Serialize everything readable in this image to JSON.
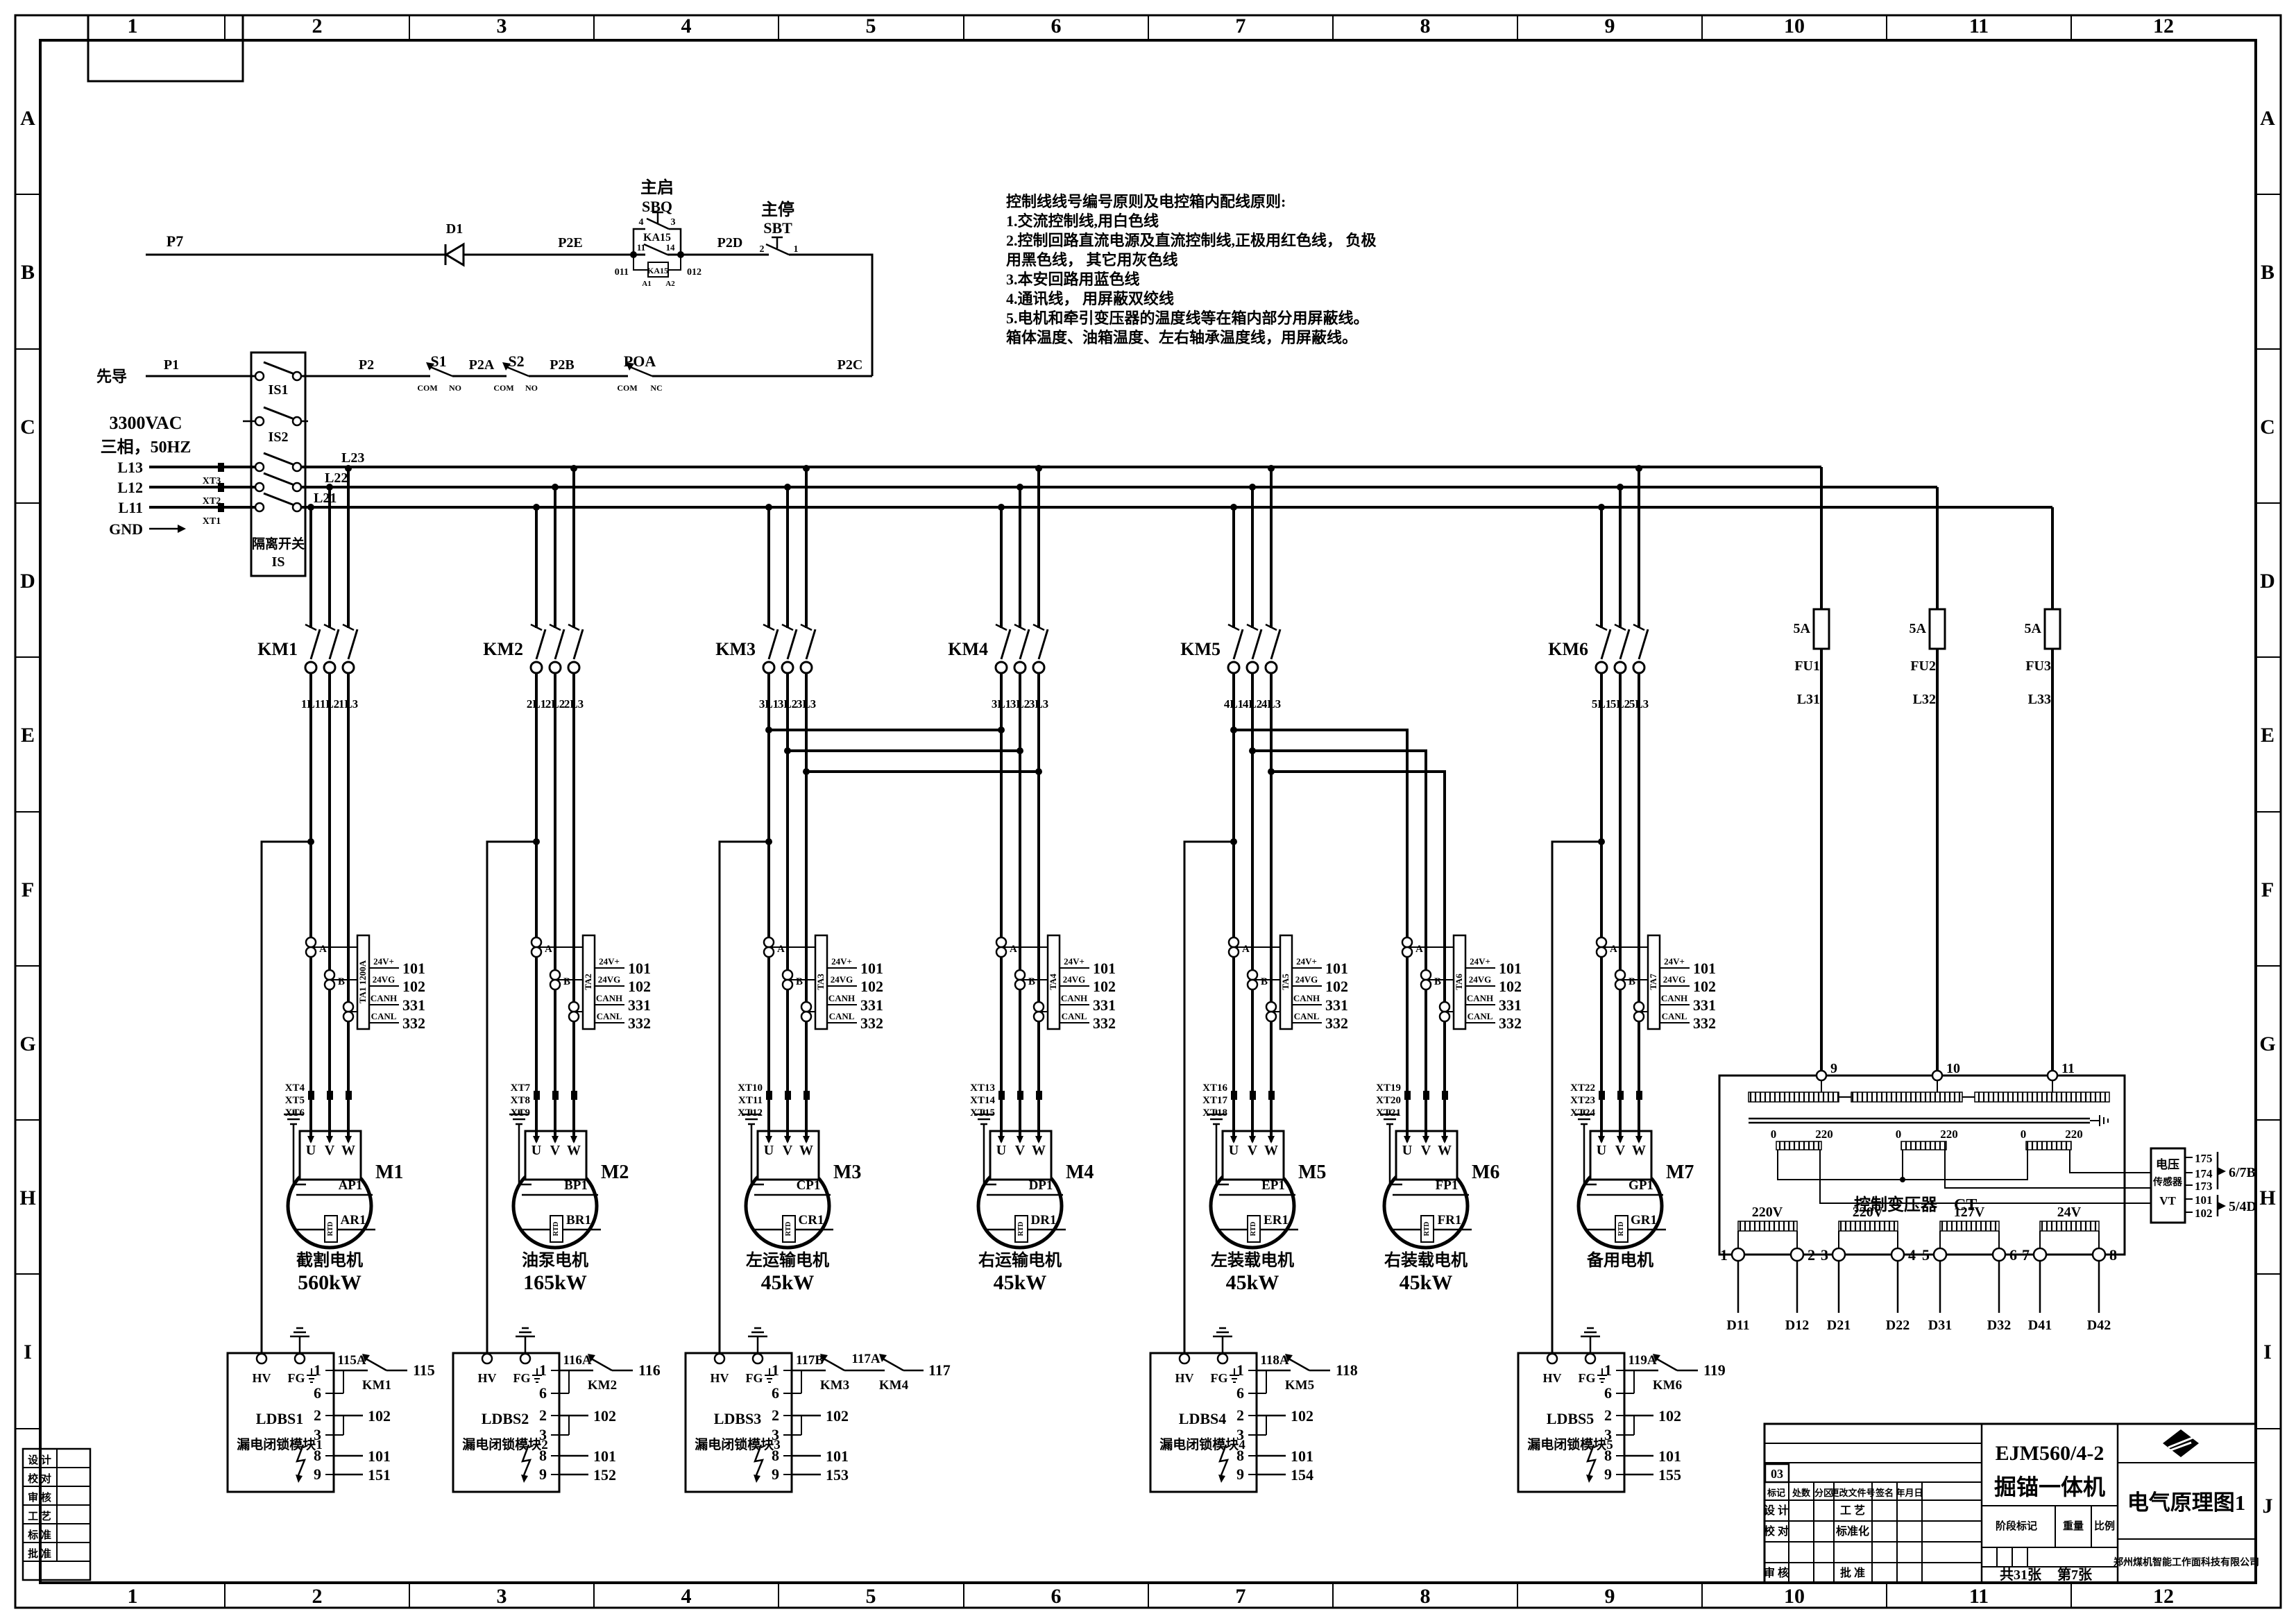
{
  "sheet": {
    "cols": [
      "1",
      "2",
      "3",
      "4",
      "5",
      "6",
      "7",
      "8",
      "9",
      "10",
      "11",
      "12"
    ],
    "rows": [
      "A",
      "B",
      "C",
      "D",
      "E",
      "F",
      "G",
      "H",
      "I",
      "J"
    ],
    "rows_left": [
      "A",
      "B",
      "C",
      "D",
      "E",
      "F",
      "G",
      "H",
      "I"
    ]
  },
  "notes": {
    "lines": [
      "控制线线号编号原则及电控箱内配线原则:",
      "1.交流控制线,用白色线",
      "2.控制回路直流电源及直流控制线,正极用红色线， 负极",
      "用黑色线， 其它用灰色线",
      "3.本安回路用蓝色线",
      "4.通讯线， 用屏蔽双绞线",
      "5.电机和牵引变压器的温度线等在箱内部分用屏蔽线。",
      "箱体温度、油箱温度、左右轴承温度线，用屏蔽线。"
    ]
  },
  "pilot": {
    "p7": "P7",
    "d1": "D1",
    "p2e": "P2E",
    "start_cn": "主启",
    "start_ref": "SBQ",
    "t4": "4",
    "t3": "3",
    "ka": "KA15",
    "t11": "11",
    "t14": "14",
    "t011": "011",
    "a1": "A1",
    "a2": "A2",
    "t012": "012",
    "p2d": "P2D",
    "stop_cn": "主停",
    "stop_ref": "SBT",
    "t2": "2",
    "t1": "1",
    "lead_cn": "先导",
    "p1": "P1",
    "is1": "IS1",
    "p2": "P2",
    "s1": "S1",
    "s2": "S2",
    "com": "COM",
    "no": "NO",
    "nc": "NC",
    "p2a": "P2A",
    "p2b": "P2B",
    "poa": "POA",
    "p2c": "P2C"
  },
  "source": {
    "v": "3300VAC",
    "ph": "三相，50HZ",
    "l13": "L13",
    "l12": "L12",
    "l11": "L11",
    "xt3": "XT3",
    "xt2": "XT2",
    "xt1": "XT1",
    "gnd": "GND",
    "is2": "IS2",
    "iso_cn": "隔离开关",
    "iso": "IS",
    "l21": "L21",
    "l22": "L22",
    "l23": "L23"
  },
  "shared": {
    "a": "A",
    "b": "B",
    "c": "C",
    "u": "U",
    "v": "V",
    "w": "W",
    "rtd": "RTD",
    "t24vp": "24V+",
    "t24vg": "24VG",
    "canh": "CANH",
    "canl": "CANL",
    "n101": "101",
    "n102": "102",
    "n331": "331",
    "n332": "332",
    "hv": "HV",
    "fg": "FG",
    "k1": "1",
    "k6": "6",
    "k2": "2",
    "k3": "3",
    "k8": "8",
    "k9": "9"
  },
  "branches": [
    {
      "km": "KM1",
      "w1": "1L1",
      "w2": "1L2",
      "w3": "1L3",
      "ta": "TA1 1200A",
      "xt1": "XT4",
      "xt2": "XT5",
      "xt3": "XT6",
      "m": "M1",
      "p": "AP1",
      "r": "AR1",
      "name": "截割电机",
      "kw": "560kW"
    },
    {
      "km": "KM2",
      "w1": "2L1",
      "w2": "2L2",
      "w3": "2L3",
      "ta": "TA2",
      "xt1": "XT7",
      "xt2": "XT8",
      "xt3": "XT9",
      "m": "M2",
      "p": "BP1",
      "r": "BR1",
      "name": "油泵电机",
      "kw": "165kW"
    },
    {
      "km": "KM3",
      "w1": "3L1",
      "w2": "3L2",
      "w3": "3L3",
      "ta": "TA3",
      "xt1": "XT10",
      "xt2": "XT11",
      "xt3": "XT12",
      "m": "M3",
      "p": "CP1",
      "r": "CR1",
      "name": "左运输电机",
      "kw": "45kW"
    },
    {
      "km": "KM4",
      "w1": "3L1",
      "w2": "3L2",
      "w3": "3L3",
      "ta": "TA4",
      "xt1": "XT13",
      "xt2": "XT14",
      "xt3": "XT15",
      "m": "M4",
      "p": "DP1",
      "r": "DR1",
      "name": "右运输电机",
      "kw": "45kW"
    },
    {
      "km": "KM5",
      "w1": "4L1",
      "w2": "4L2",
      "w3": "4L3",
      "ta": "TA5",
      "xt1": "XT16",
      "xt2": "XT17",
      "xt3": "XT18",
      "m": "M5",
      "p": "EP1",
      "r": "ER1",
      "name": "左装载电机",
      "kw": "45kW"
    },
    {
      "ta": "TA6",
      "xt1": "XT19",
      "xt2": "XT20",
      "xt3": "XT21",
      "m": "M6",
      "p": "FP1",
      "r": "FR1",
      "name": "右装载电机",
      "kw": "45kW"
    },
    {
      "km": "KM6",
      "w1": "5L1",
      "w2": "5L2",
      "w3": "5L3",
      "ta": "TA7",
      "xt1": "XT22",
      "xt2": "XT23",
      "xt3": "XT24",
      "m": "M7",
      "p": "GP1",
      "r": "GR1",
      "name": "备用电机"
    }
  ],
  "modules": [
    {
      "name": "LDBS1",
      "cname": "漏电闭锁模块1",
      "w1": "115A",
      "km": "KM1",
      "end": "115",
      "w9": "151"
    },
    {
      "name": "LDBS2",
      "cname": "漏电闭锁模块2",
      "w1": "116A",
      "km": "KM2",
      "end": "116",
      "w9": "152"
    },
    {
      "name": "LDBS3",
      "cname": "漏电闭锁模块3",
      "w1": "117B",
      "km": "KM3",
      "mid": "117A",
      "km2": "KM4",
      "end2": "117",
      "w9": "153"
    },
    {
      "name": "LDBS4",
      "cname": "漏电闭锁模块4",
      "w1": "118A",
      "km": "KM5",
      "end": "118",
      "w9": "154"
    },
    {
      "name": "LDBS5",
      "cname": "漏电闭锁模块5",
      "w1": "119A",
      "km": "KM6",
      "end": "119",
      "w9": "155"
    }
  ],
  "fuses": [
    {
      "amp": "5A",
      "name": "FU1",
      "wire": "L31"
    },
    {
      "amp": "5A",
      "name": "FU2",
      "wire": "L32"
    },
    {
      "amp": "5A",
      "name": "FU3",
      "wire": "L33"
    }
  ],
  "ct": {
    "t9": "9",
    "t10": "10",
    "t11": "11",
    "zero": "0",
    "v220": "220",
    "title": "控制变压器",
    "ref": "CT",
    "sec": [
      {
        "a": "1",
        "v": "220V",
        "b": "2",
        "da": "D11",
        "db": "D12"
      },
      {
        "a": "3",
        "v": "220V",
        "b": "4",
        "da": "D21",
        "db": "D22"
      },
      {
        "a": "5",
        "v": "127V",
        "b": "6",
        "da": "D31",
        "db": "D32"
      },
      {
        "a": "7",
        "v": "24V",
        "b": "8",
        "da": "D41",
        "db": "D42"
      }
    ]
  },
  "vt": {
    "l1": "电压",
    "l2": "传感器",
    "l3": "VT",
    "t": [
      "175",
      "174",
      "173",
      "101",
      "102"
    ],
    "g1": "6/7B",
    "g2": "5/4D"
  },
  "title_block": {
    "model": "EJM560/4-2",
    "product": "掘锚一体机",
    "drawing": "电气原理图1",
    "company": "郑州煤机智能工作面科技有限公司",
    "mark": "03",
    "hdr": [
      "标记",
      "处数",
      "分区",
      "更改文件号",
      "签名",
      "年月日"
    ],
    "r1a": "设 计",
    "r1b": "工 艺",
    "r2a": "校 对",
    "r2b": "标准化",
    "r3a": "审 核",
    "r3b": "批 准",
    "stage": "阶段标记",
    "weight": "重量",
    "scale": "比例",
    "total": "共31张",
    "page": "第7张"
  },
  "sig": {
    "rows": [
      "设 计",
      "校 对",
      "审 核",
      "工 艺",
      "标 准",
      "批 准"
    ]
  }
}
